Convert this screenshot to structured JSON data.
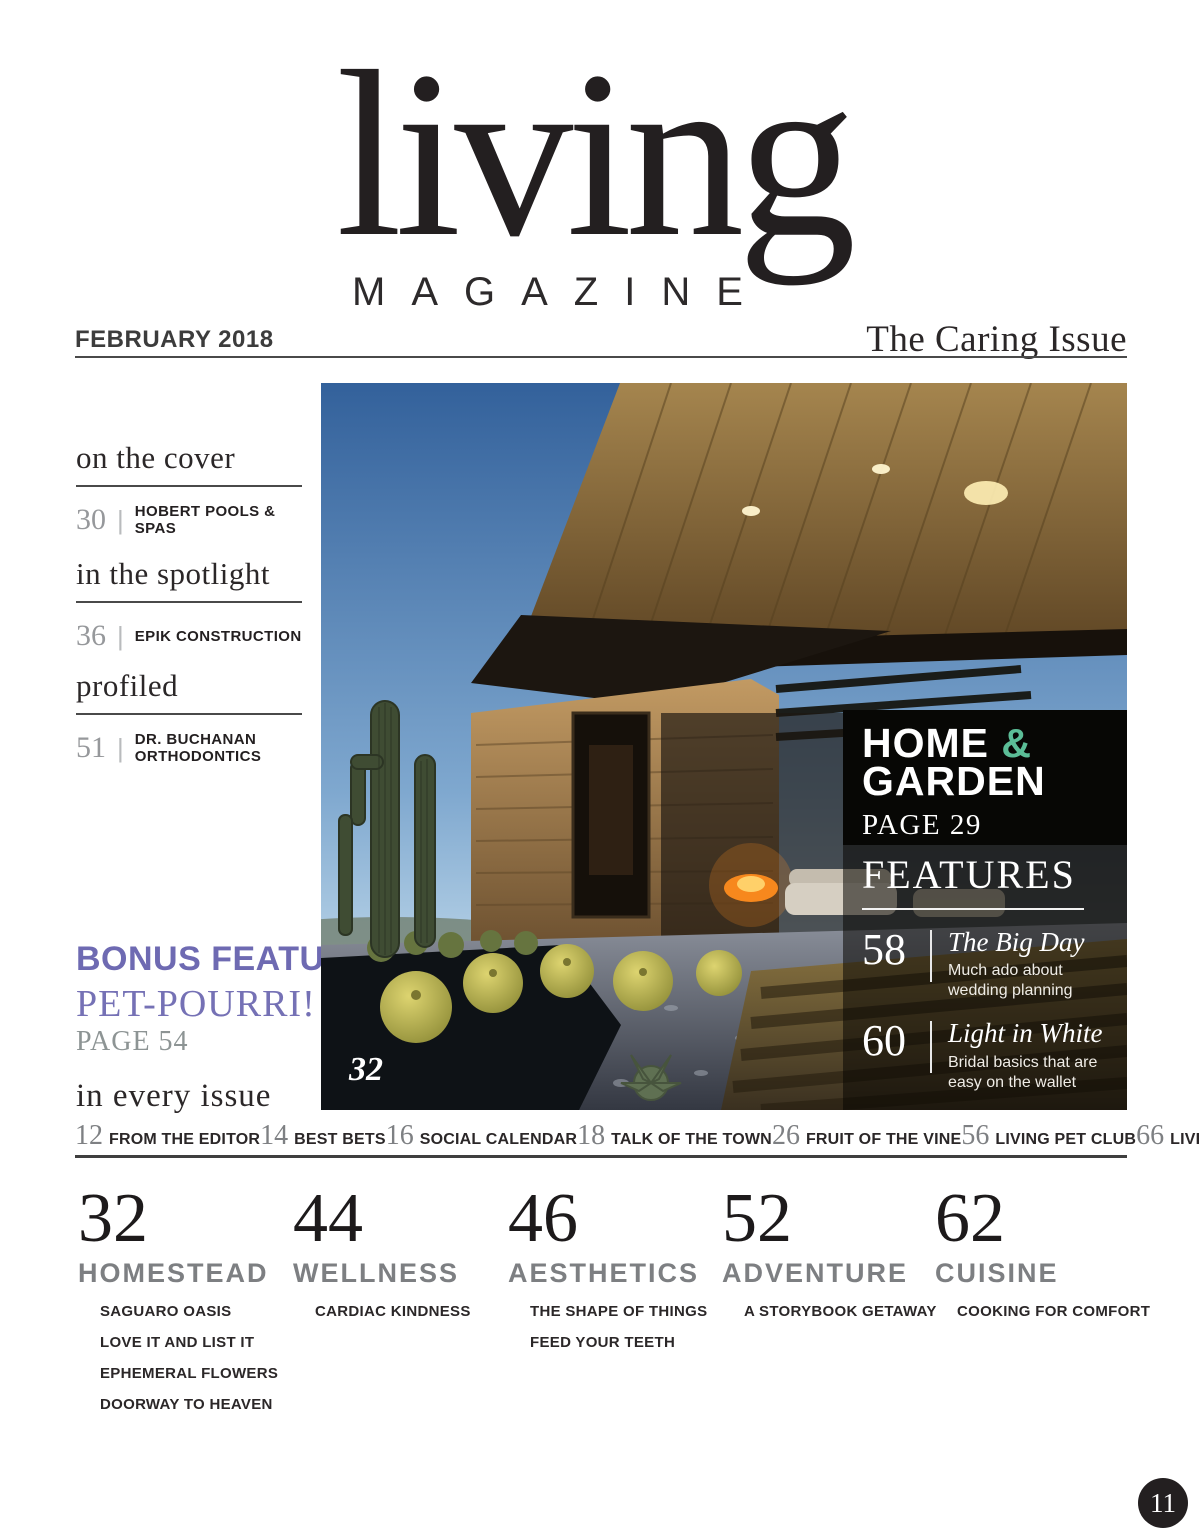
{
  "masthead": {
    "title": "living",
    "subtitle": "MAGAZINE",
    "date": "FEBRUARY 2018",
    "issue": "The Caring Issue"
  },
  "ui": {
    "divider": "|"
  },
  "colors": {
    "ink": "#231f20",
    "accent_purple": "#7571b5",
    "accent_teal": "#5bbd97",
    "gray_label": "#7d7f82"
  },
  "sidebar": {
    "sections": [
      {
        "heading": "on the cover",
        "entries": [
          {
            "page": "30",
            "label": "HOBERT POOLS & SPAS"
          }
        ]
      },
      {
        "heading": "in the spotlight",
        "entries": [
          {
            "page": "36",
            "label": "EPIK CONSTRUCTION"
          }
        ]
      },
      {
        "heading": "profiled",
        "entries": [
          {
            "page": "51",
            "label": "DR. BUCHANAN ORTHODONTICS"
          }
        ]
      }
    ],
    "bonus": {
      "kicker": "BONUS FEATURE",
      "title": "PET-POURRI!",
      "page": "PAGE 54"
    },
    "every_issue_heading": "in every issue"
  },
  "cover": {
    "photo_page": "32",
    "home_garden": {
      "word1": "HOME ",
      "amp": "&",
      "word2": "GARDEN",
      "page": "PAGE 29"
    },
    "features": {
      "heading": "FEATURES",
      "items": [
        {
          "page": "58",
          "title": "The Big Day",
          "desc": "Much ado about wedding planning"
        },
        {
          "page": "60",
          "title": "Light in White",
          "desc": "Bridal basics that are easy on the wallet"
        }
      ]
    }
  },
  "every_issue": {
    "items": [
      {
        "page": "12",
        "label": "FROM THE EDITOR"
      },
      {
        "page": "14",
        "label": "BEST BETS"
      },
      {
        "page": "16",
        "label": "SOCIAL CALENDAR"
      },
      {
        "page": "18",
        "label": "TALK OF THE TOWN"
      },
      {
        "page": "26",
        "label": "FRUIT OF THE VINE"
      },
      {
        "page": "56",
        "label": "LIVING PET CLUB"
      },
      {
        "page": "66",
        "label": "LIVING LIKES"
      }
    ]
  },
  "departments": [
    {
      "page": "32",
      "name": "HOMESTEAD",
      "articles": [
        "SAGUARO OASIS",
        "LOVE IT AND LIST IT",
        "EPHEMERAL FLOWERS",
        "DOORWAY TO HEAVEN"
      ]
    },
    {
      "page": "44",
      "name": "WELLNESS",
      "articles": [
        "CARDIAC KINDNESS"
      ]
    },
    {
      "page": "46",
      "name": "AESTHETICS",
      "articles": [
        "THE SHAPE OF THINGS",
        "FEED YOUR TEETH"
      ]
    },
    {
      "page": "52",
      "name": "ADVENTURE",
      "articles": [
        "A STORYBOOK GETAWAY"
      ]
    },
    {
      "page": "62",
      "name": "CUISINE",
      "articles": [
        "COOKING FOR COMFORT"
      ]
    }
  ],
  "folio": {
    "page_number": "11"
  }
}
